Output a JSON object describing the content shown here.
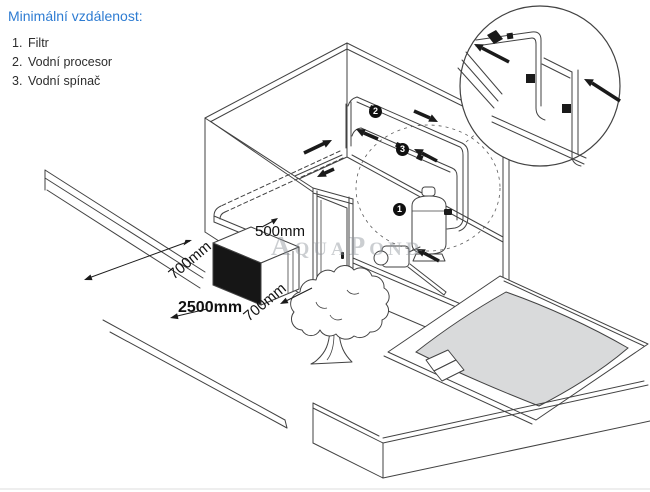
{
  "title": "Minimální vzdálenost:",
  "legend": [
    {
      "num": "1.",
      "label": "Filtr"
    },
    {
      "num": "2.",
      "label": "Vodní procesor"
    },
    {
      "num": "3.",
      "label": "Vodní spínač"
    }
  ],
  "dimensions": {
    "wall_gap": "500mm",
    "side_left": "700mm",
    "front": "2500mm",
    "side_right": "700mm"
  },
  "markers": {
    "filter": "1",
    "processor": "2",
    "switch": "3"
  },
  "watermark": "AquaPond",
  "colors": {
    "accent": "#2E7CD2",
    "line": "#424242",
    "ink": "#1a1a1a",
    "pool-water": "#d9dadb",
    "watermark": "#8e949b"
  }
}
